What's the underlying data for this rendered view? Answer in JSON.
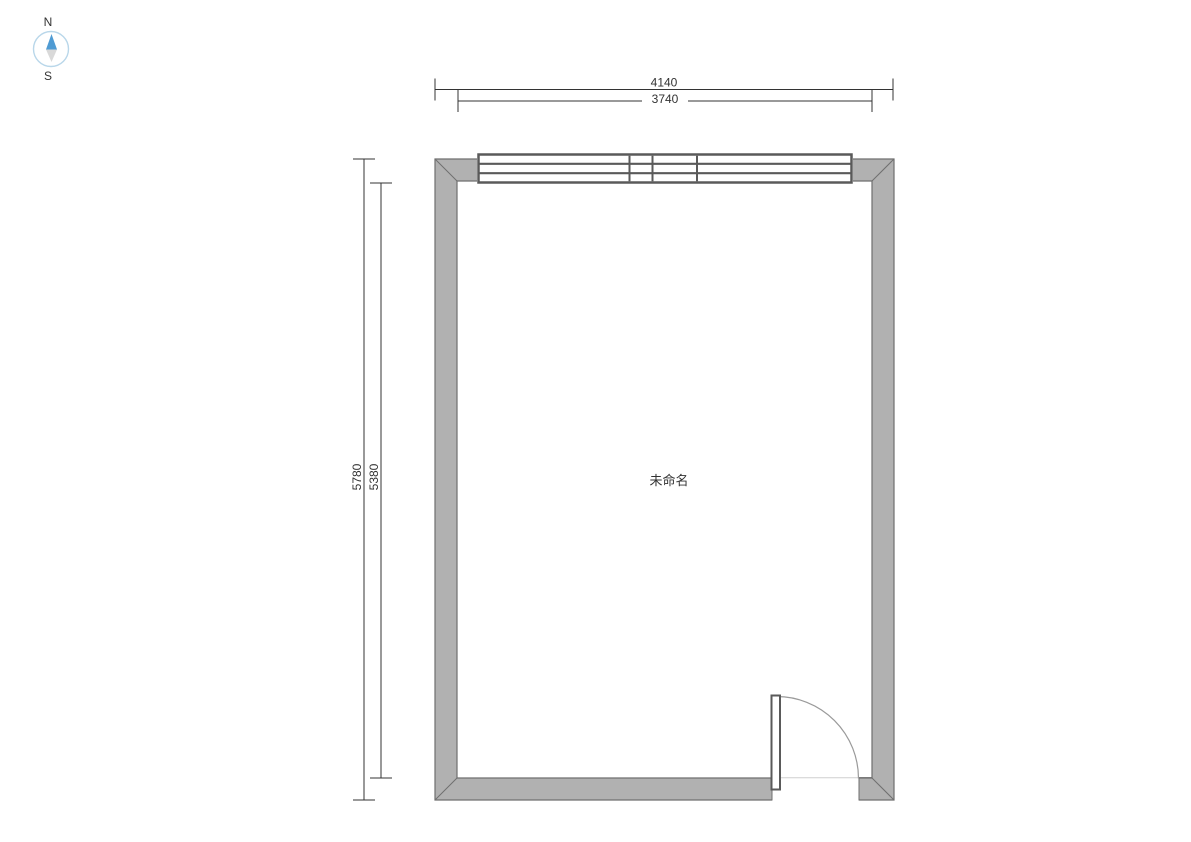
{
  "compass": {
    "north_label": "N",
    "south_label": "S"
  },
  "dimensions": {
    "top_outer": "4140",
    "top_inner": "3740",
    "left_outer": "5780",
    "left_inner": "5380"
  },
  "room": {
    "label": "未命名"
  },
  "colors": {
    "wall_fill": "#b1b1b1",
    "wall_outline": "#6f6f6f",
    "window_line": "#5a5a5a",
    "dimension": "#333333",
    "door_swing_arc": "#9a9a9a",
    "door_threshold": "#cfcfcf",
    "compass_needle_north": "#4f9bd3",
    "compass_needle_south": "#d9d9d9",
    "compass_ring": "#b9d7ea",
    "text": "#333333"
  }
}
